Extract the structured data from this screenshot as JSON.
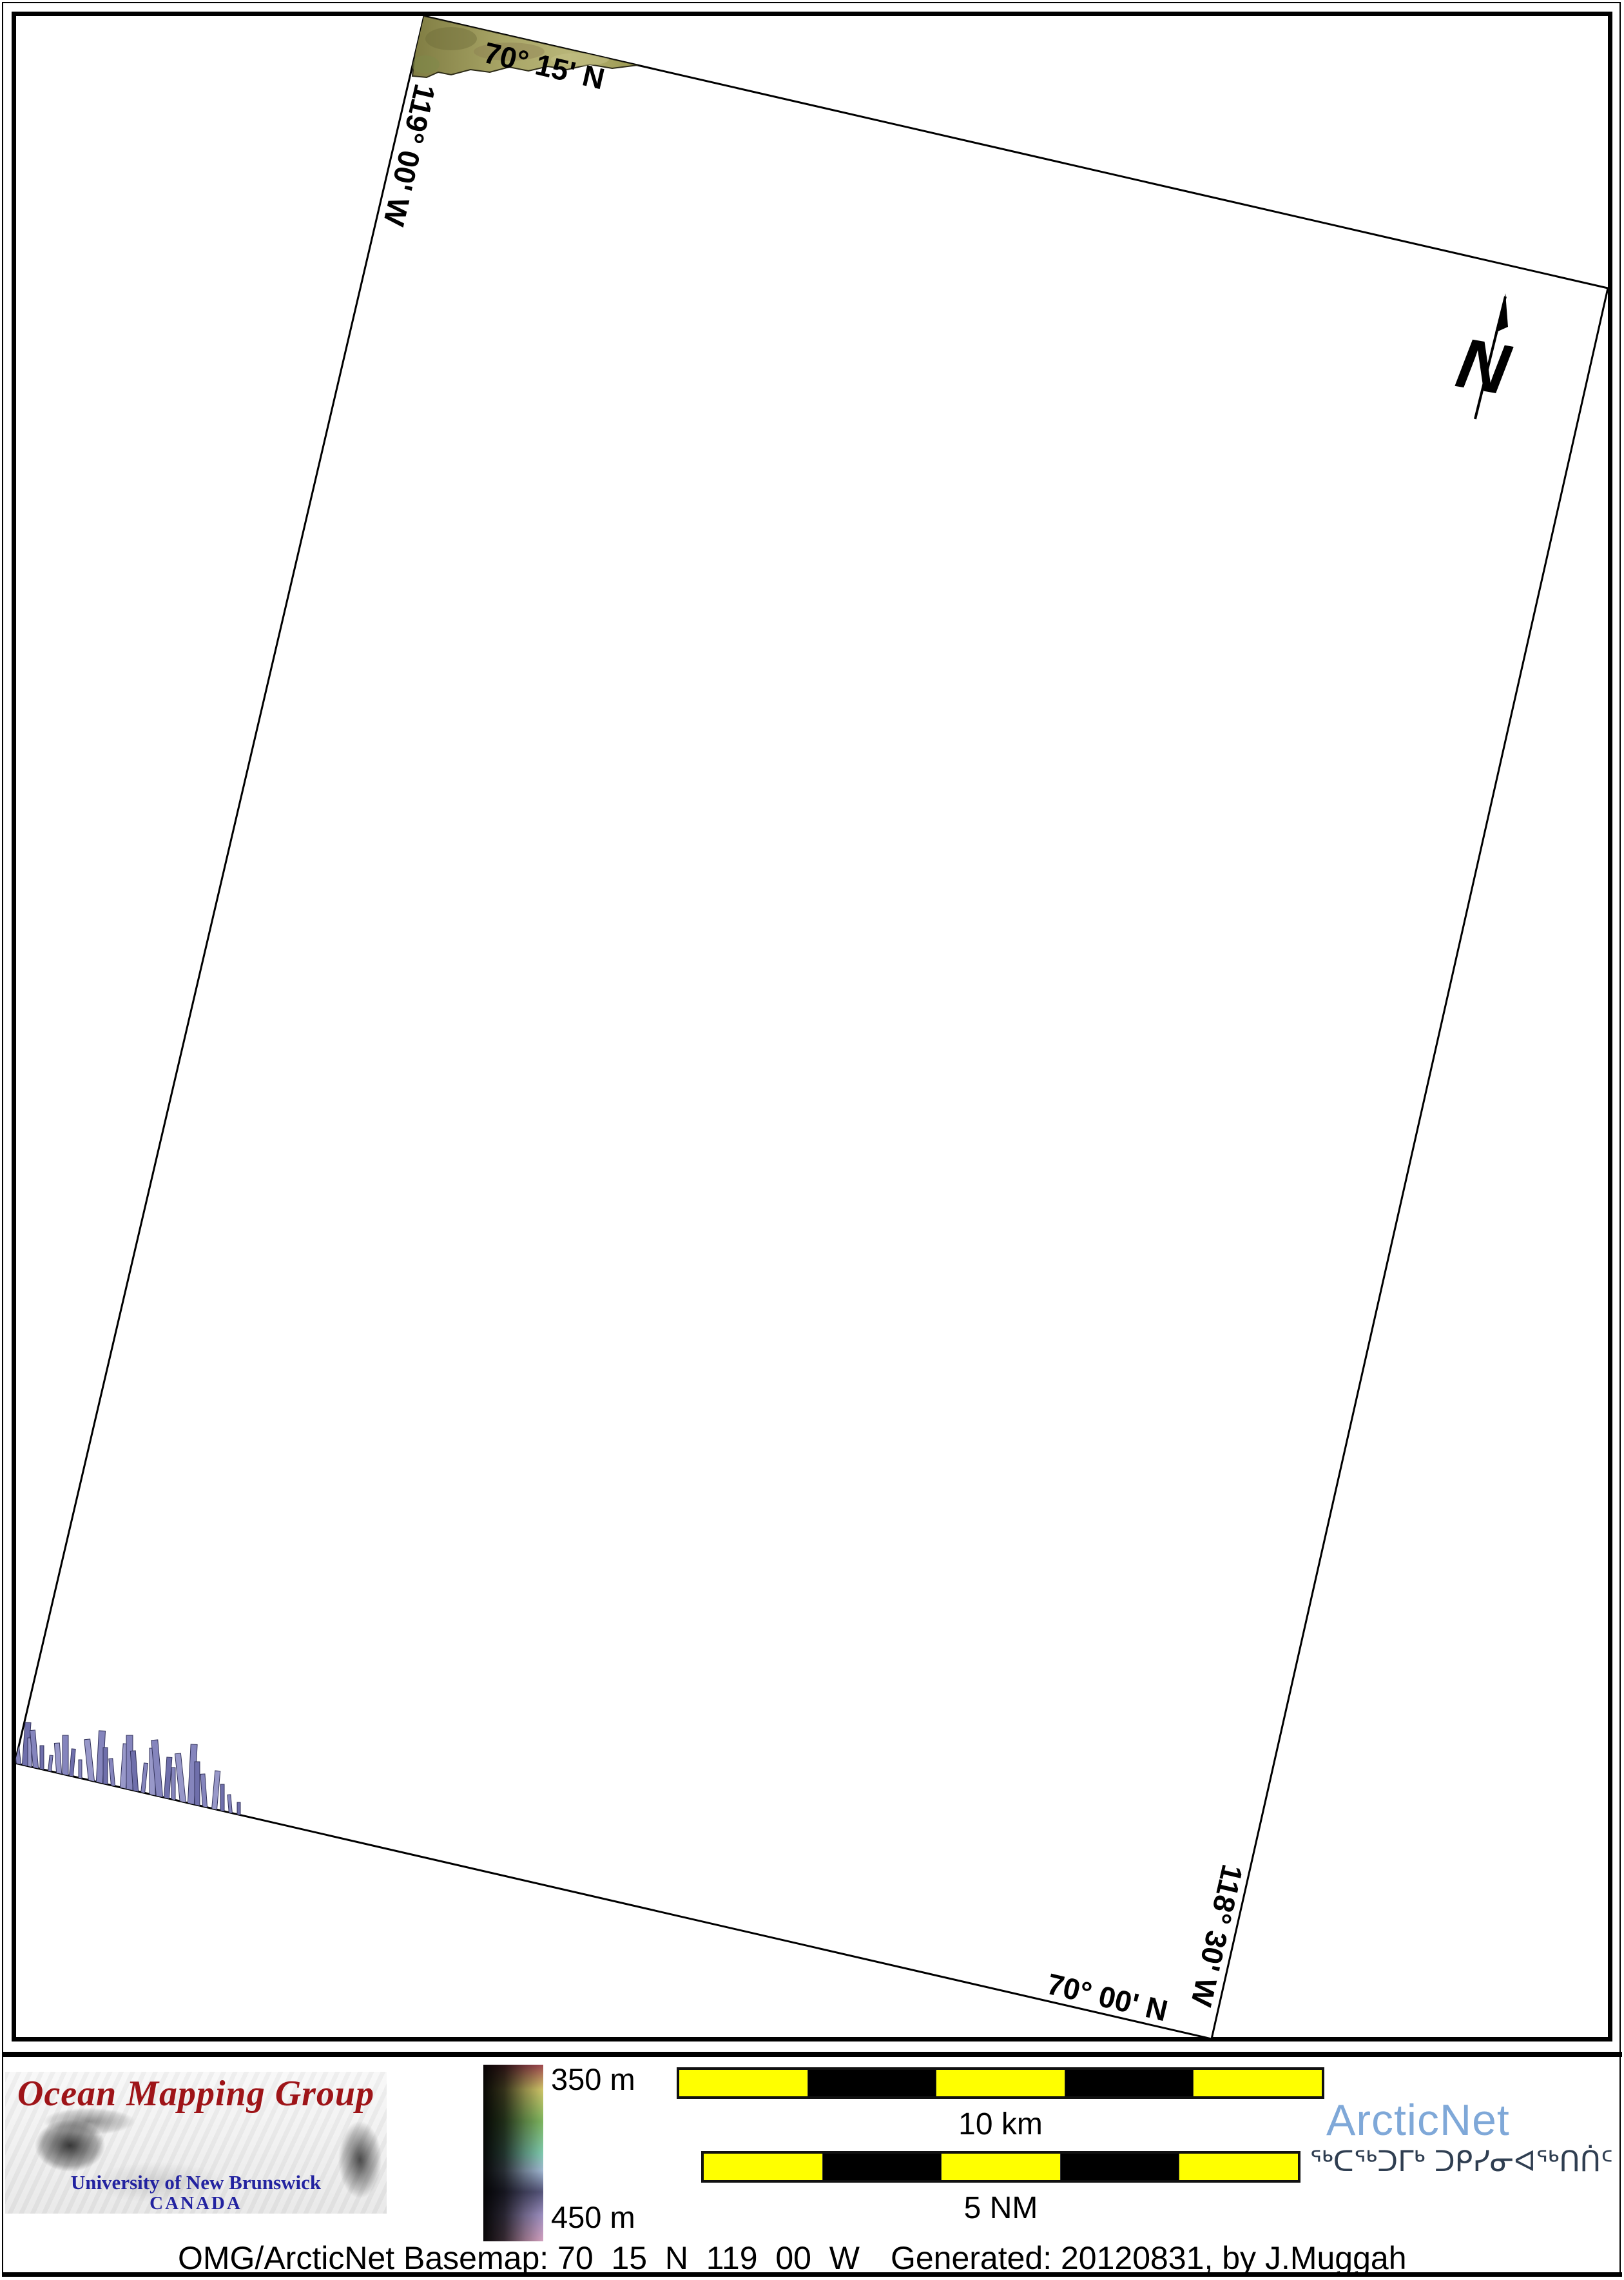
{
  "map": {
    "grid_labels": {
      "top_lat": "70° 15' N",
      "left_lon": "119° 00' W",
      "right_lon": "118° 30' W",
      "bottom_lat": "70° 00' N"
    },
    "north_arrow_letter": "N"
  },
  "legend": {
    "depth_shallow": "350 m",
    "depth_deep": "450 m"
  },
  "scalebars": {
    "km_label": "10 km",
    "nm_label": "5 NM"
  },
  "logos": {
    "omg_title": "Ocean Mapping Group",
    "omg_university": "University of New Brunswick",
    "omg_country": "CANADA",
    "arcticnet_name": "ArcticNet",
    "arcticnet_inuktitut": "ᖅᑕᖅᑐᒥᒃ ᑐᑭᓯᓂᐊᖅᑎᑏᑦ"
  },
  "caption": {
    "basemap": "OMG/ArcticNet Basemap: 70_15_N_119_00_W",
    "generated": "Generated: 20120831, by J.Muggah"
  },
  "colors": {
    "omg_red": "#9e1418",
    "unb_blue": "#2323a0",
    "arcticnet_blue": "#7fa8d8",
    "inuktitut_navy": "#2f3e51",
    "scalebar_yellow": "#ffff00",
    "terrain_olive": "#a3a05e",
    "swath_purple": "#8585bd"
  }
}
